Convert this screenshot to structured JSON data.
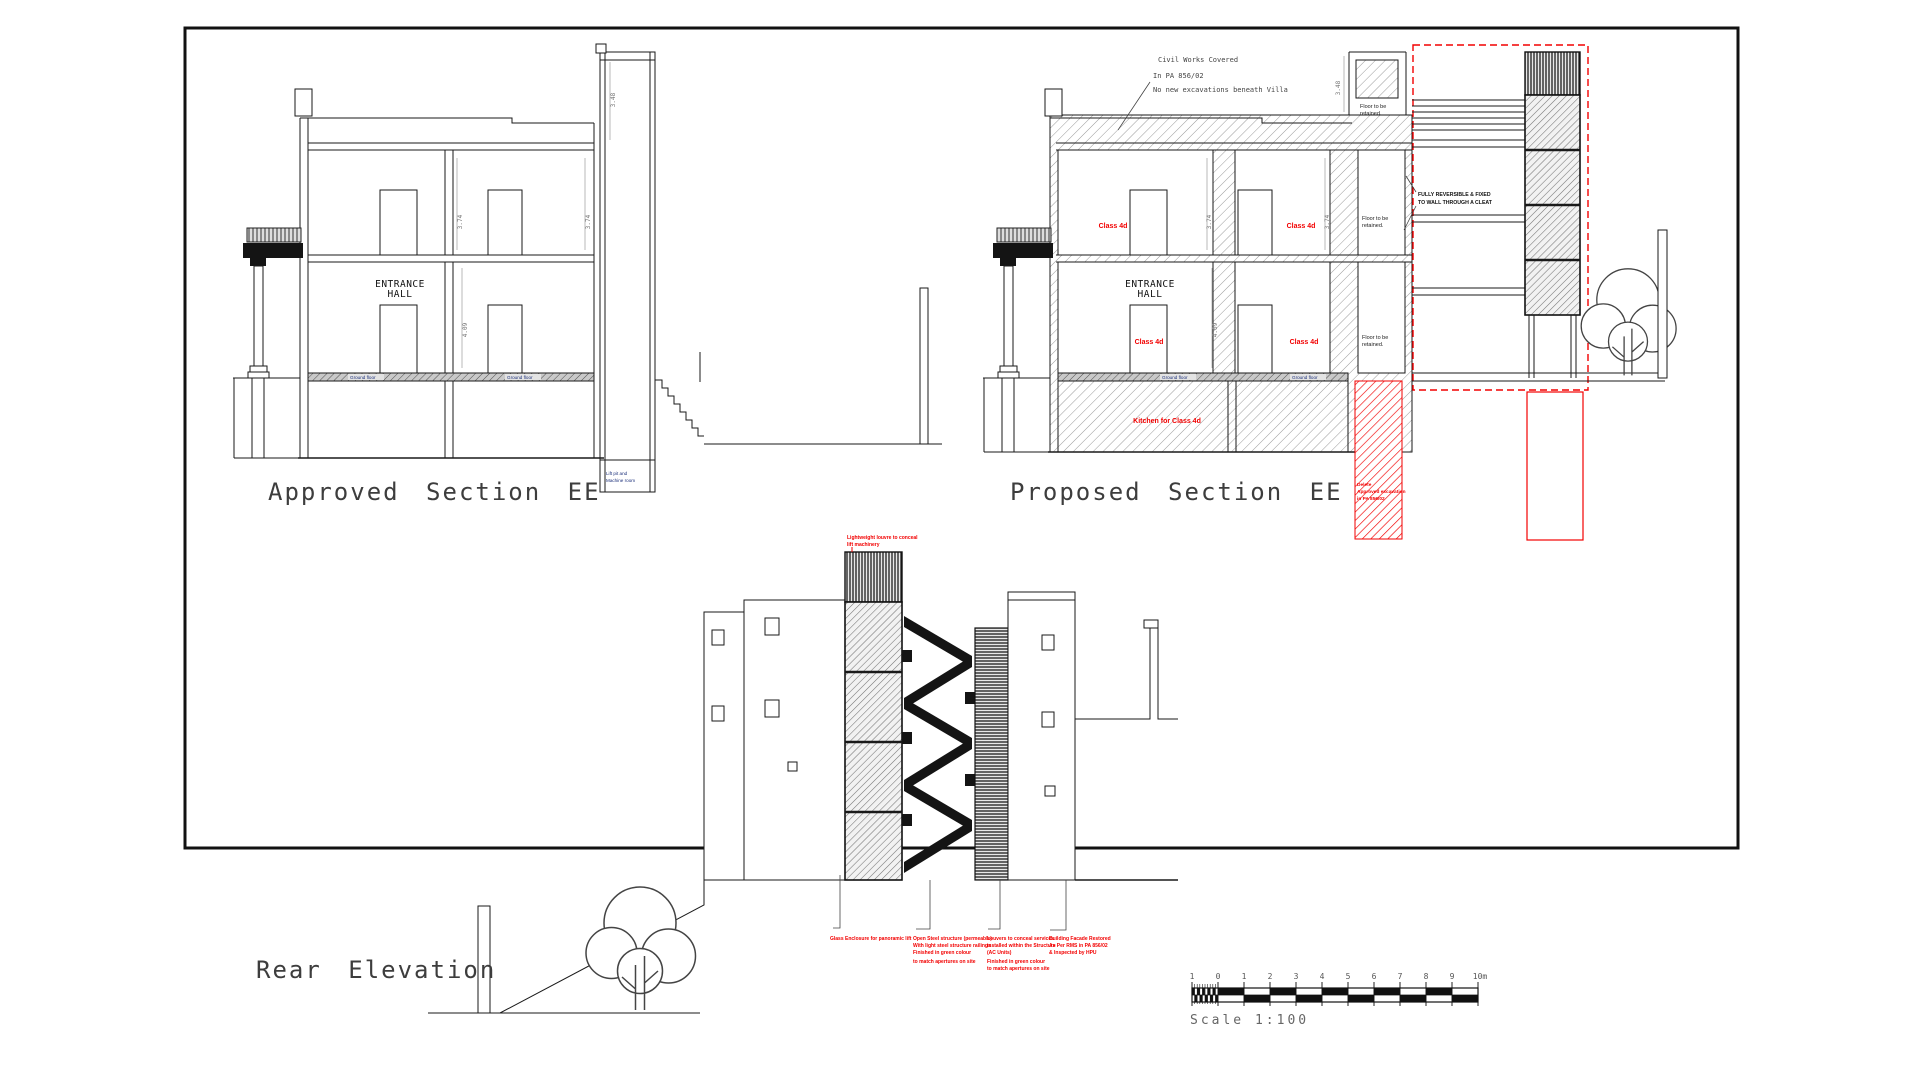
{
  "titles": {
    "approved": "Approved Section EE",
    "proposed": "Proposed Section EE",
    "rear": "Rear Elevation"
  },
  "approved": {
    "entrance_hall": [
      "ENTRANCE",
      "HALL"
    ],
    "lift_pit": [
      "Lift pit and",
      "Machine room"
    ],
    "slab_label_left": "Ground floor",
    "slab_label_right": "Ground floor",
    "dim_upper_left": "3.74",
    "dim_upper_right": "3.74",
    "dim_ground": "4.09",
    "dim_tower": "3.48"
  },
  "proposed": {
    "note": [
      "Civil Works Covered",
      "In PA 856/02",
      "No new excavations beneath Villa"
    ],
    "entrance_hall": [
      "ENTRANCE",
      "HALL"
    ],
    "class_4d": "Class 4d",
    "floor_retained": [
      "Floor to be",
      "retained."
    ],
    "kitchen": "Kitchen for Class 4d",
    "delete_note": [
      "Delete",
      "Approved excavation",
      "in PA 856/02"
    ],
    "reversible_note": [
      "FULLY REVERSIBLE & FIXED",
      "TO WALL THROUGH A CLEAT"
    ],
    "slab_label_left": "Ground floor",
    "slab_label_right": "Ground floor",
    "dim_upper_left": "3.74",
    "dim_upper_right": "3.74",
    "dim_ground": "4.09",
    "dim_tower": "3.48"
  },
  "rear": {
    "louvre_note": [
      "Lightweight louvre to conceal",
      "lift machinery"
    ],
    "annotations": [
      {
        "lines": [
          "Glass Enclosure for panoramic lift"
        ]
      },
      {
        "lines": [
          "Open Steel structure (permeable)",
          "With light steel structure railings",
          "Finished in green colour",
          "to match apertures on site"
        ]
      },
      {
        "lines": [
          "Louvers to conceal services",
          "installed within the Structure",
          "(AC Units)",
          "Finished in green colour",
          "to match apertures on site"
        ]
      },
      {
        "lines": [
          "Building Facade Restored",
          "As Per RMS in PA 856/02",
          "&    Inspected by HPU"
        ]
      }
    ]
  },
  "scale": {
    "ticks": [
      "1",
      "0",
      "1",
      "2",
      "3",
      "4",
      "5",
      "6",
      "7",
      "8",
      "9",
      "10m"
    ],
    "caption": "Scale 1:100"
  }
}
